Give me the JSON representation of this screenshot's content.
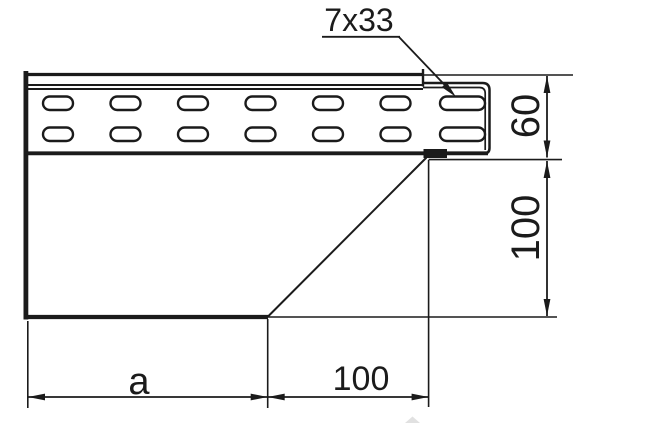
{
  "drawing": {
    "background_color": "#ffffff",
    "ink_color": "#1b1b1b",
    "labels": {
      "slot_size": "7x33",
      "rail_height": "60",
      "side_drop_height": "100",
      "bottom_width_left": "a",
      "bottom_width_right": "100"
    }
  }
}
